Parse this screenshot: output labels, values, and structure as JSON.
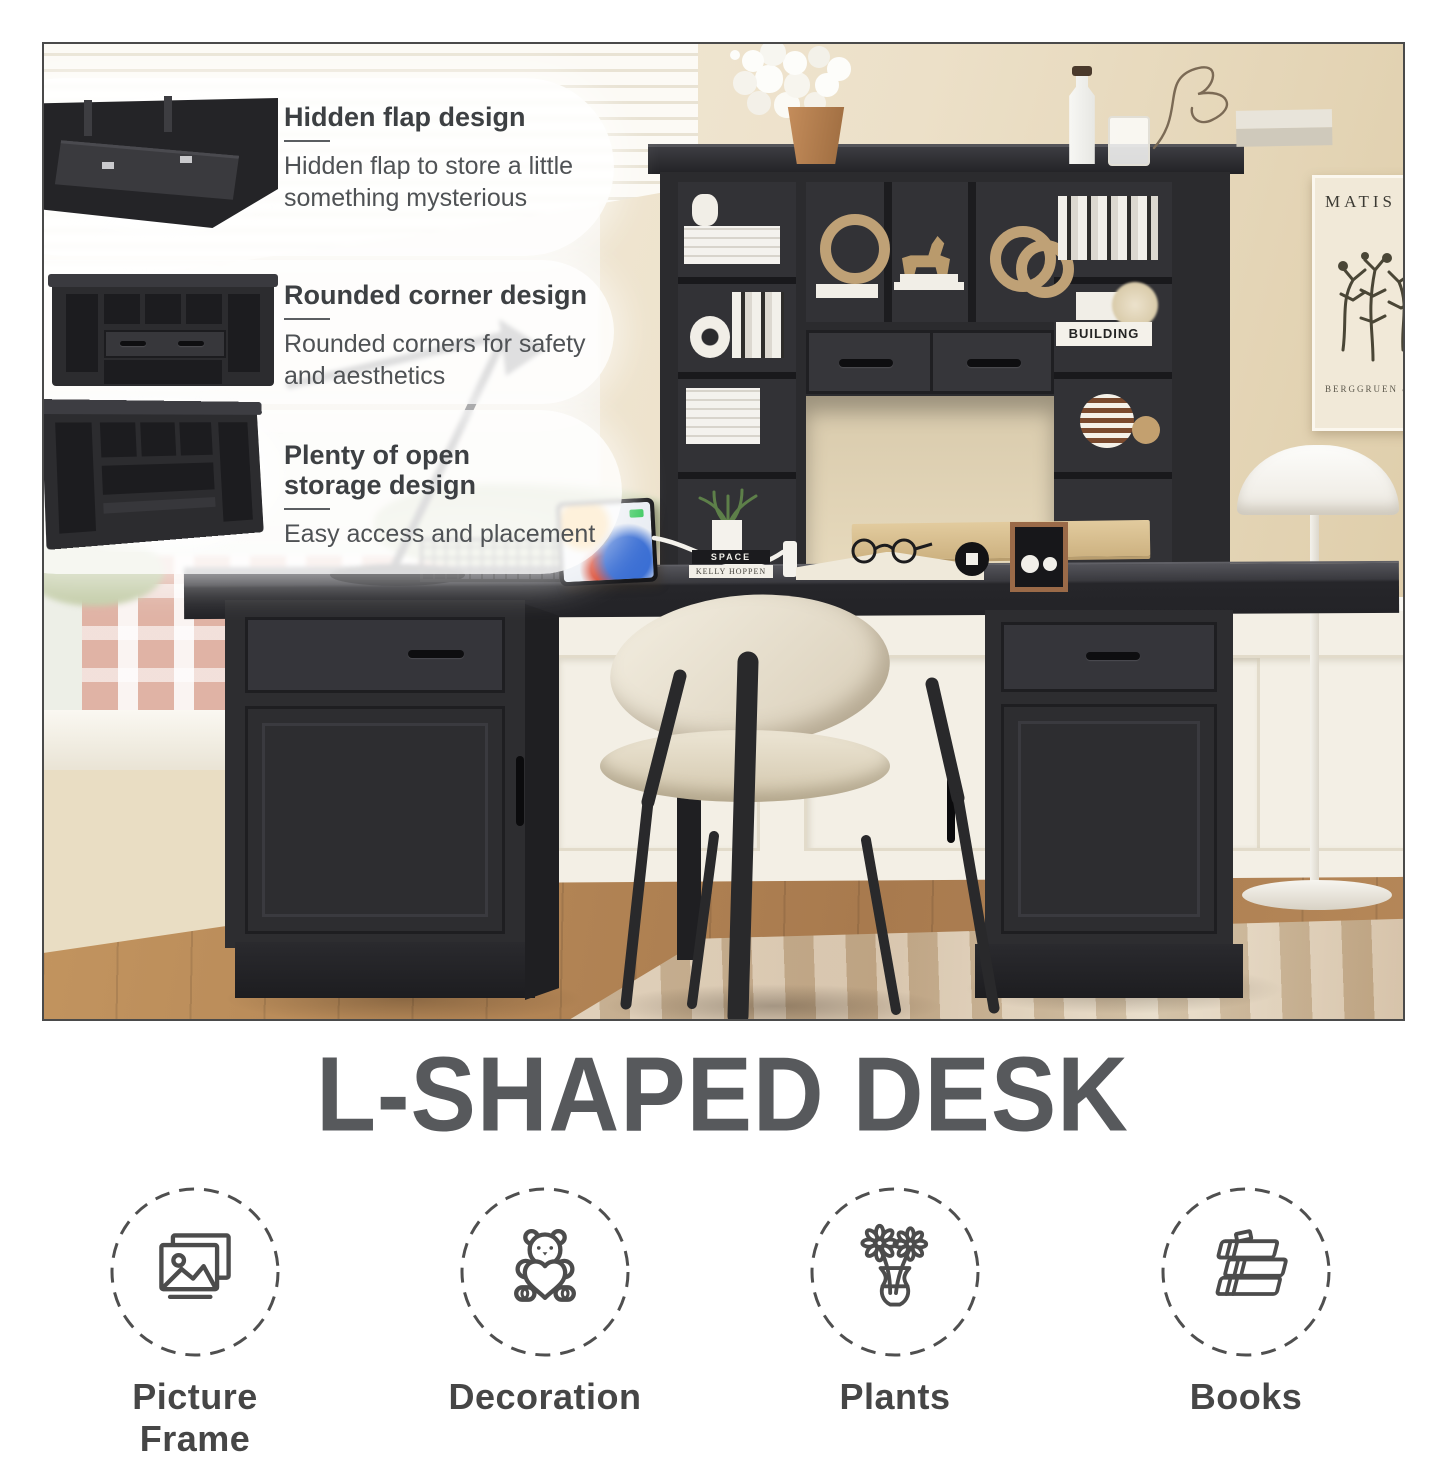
{
  "photo": {
    "callouts": [
      {
        "title": "Hidden flap design",
        "body": "Hidden flap to store a little something mysterious"
      },
      {
        "title": "Rounded corner design",
        "body": "Rounded corners for safety and aesthetics"
      },
      {
        "title": "Plenty of open\nstorage design",
        "body": "Easy access and placement"
      }
    ],
    "poster": {
      "title": "MATIS",
      "subtitle": "BERGGRUEN &"
    },
    "decor_labels": {
      "book_stack_top": "SPACE",
      "book_stack_bottom": "KELLY HOPPEN",
      "shelf_book": "BUILDING"
    }
  },
  "title": "L-SHAPED DESK",
  "features": [
    {
      "label": "Picture Frame",
      "icon": "picture-frame-icon"
    },
    {
      "label": "Decoration",
      "icon": "teddy-bear-icon"
    },
    {
      "label": "Plants",
      "icon": "flower-vase-icon"
    },
    {
      "label": "Books",
      "icon": "books-icon"
    }
  ],
  "colors": {
    "furniture_black": "#2b2b2e",
    "wall_cream": "#eadfc6",
    "title_text": "#57595c",
    "icon_stroke": "#4c4c4c",
    "floor_wood": "#b08256"
  }
}
